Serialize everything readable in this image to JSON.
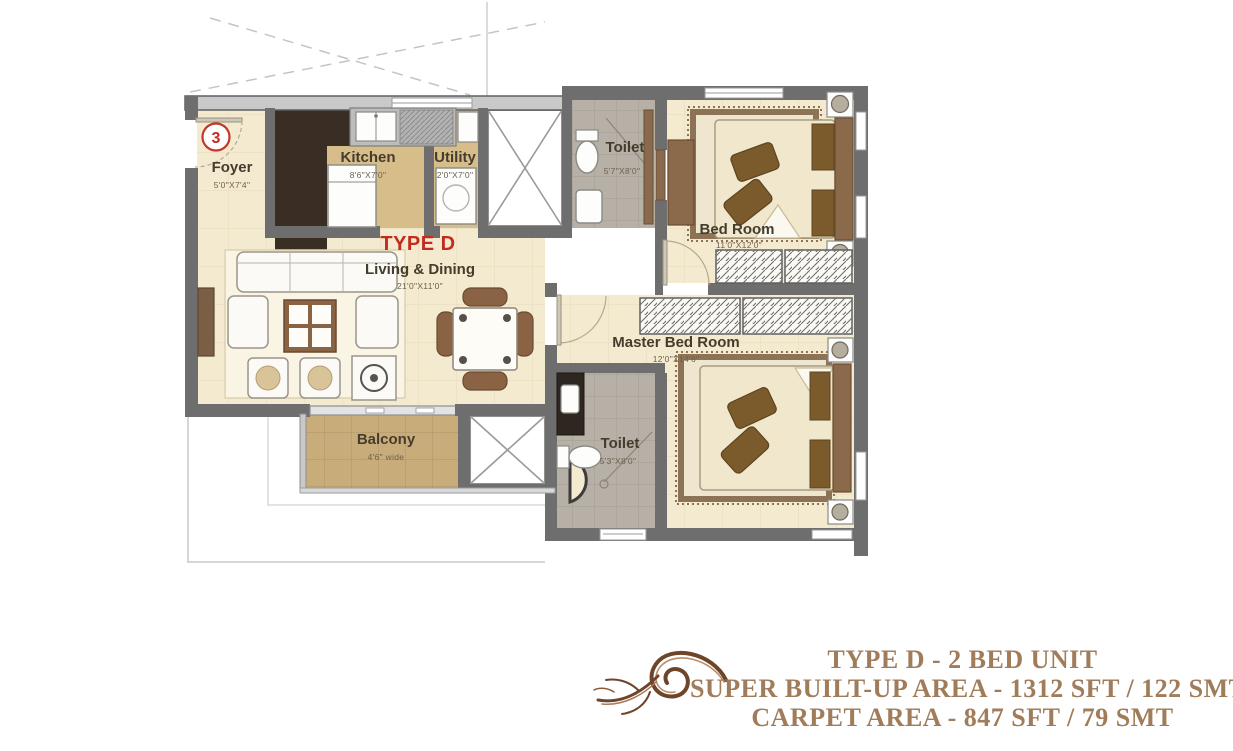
{
  "plan": {
    "unit_number": "3",
    "type_label": "TYPE D",
    "rooms": {
      "foyer": {
        "name": "Foyer",
        "dim": "5'0\"X7'4\""
      },
      "kitchen": {
        "name": "Kitchen",
        "dim": "8'6\"X7'0\""
      },
      "utility": {
        "name": "Utility",
        "dim": "2'0\"X7'0\""
      },
      "toilet_top": {
        "name": "Toilet",
        "dim": "5'7\"X8'0\""
      },
      "bed_room": {
        "name": "Bed Room",
        "dim": "11'0\"X12'0\""
      },
      "living": {
        "name": "Living & Dining",
        "dim": "21'0\"X11'0\""
      },
      "master": {
        "name": "Master Bed Room",
        "dim": "12'0\"X14'6\""
      },
      "balcony": {
        "name": "Balcony",
        "dim": "4'6\" wide"
      },
      "toilet_bottom": {
        "name": "Toilet",
        "dim": "5'3\"X8'0\""
      }
    }
  },
  "summary": {
    "title": "TYPE D - 2 BED UNIT",
    "super_built_up": "SUPER BUILT-UP AREA - 1312 SFT / 122 SMT",
    "carpet": "CARPET AREA - 847 SFT / 79 SMT"
  },
  "colors": {
    "accent_red": "#c32b1e",
    "summary_text": "#a07c5a",
    "wall": "#6e6e6e",
    "floor_cream": "#f4ead0",
    "floor_tan": "#d6bd8a",
    "floor_dark": "#3a2e24",
    "tile_gray": "#b6b0a7",
    "balcony_tan": "#c8ad7a"
  }
}
